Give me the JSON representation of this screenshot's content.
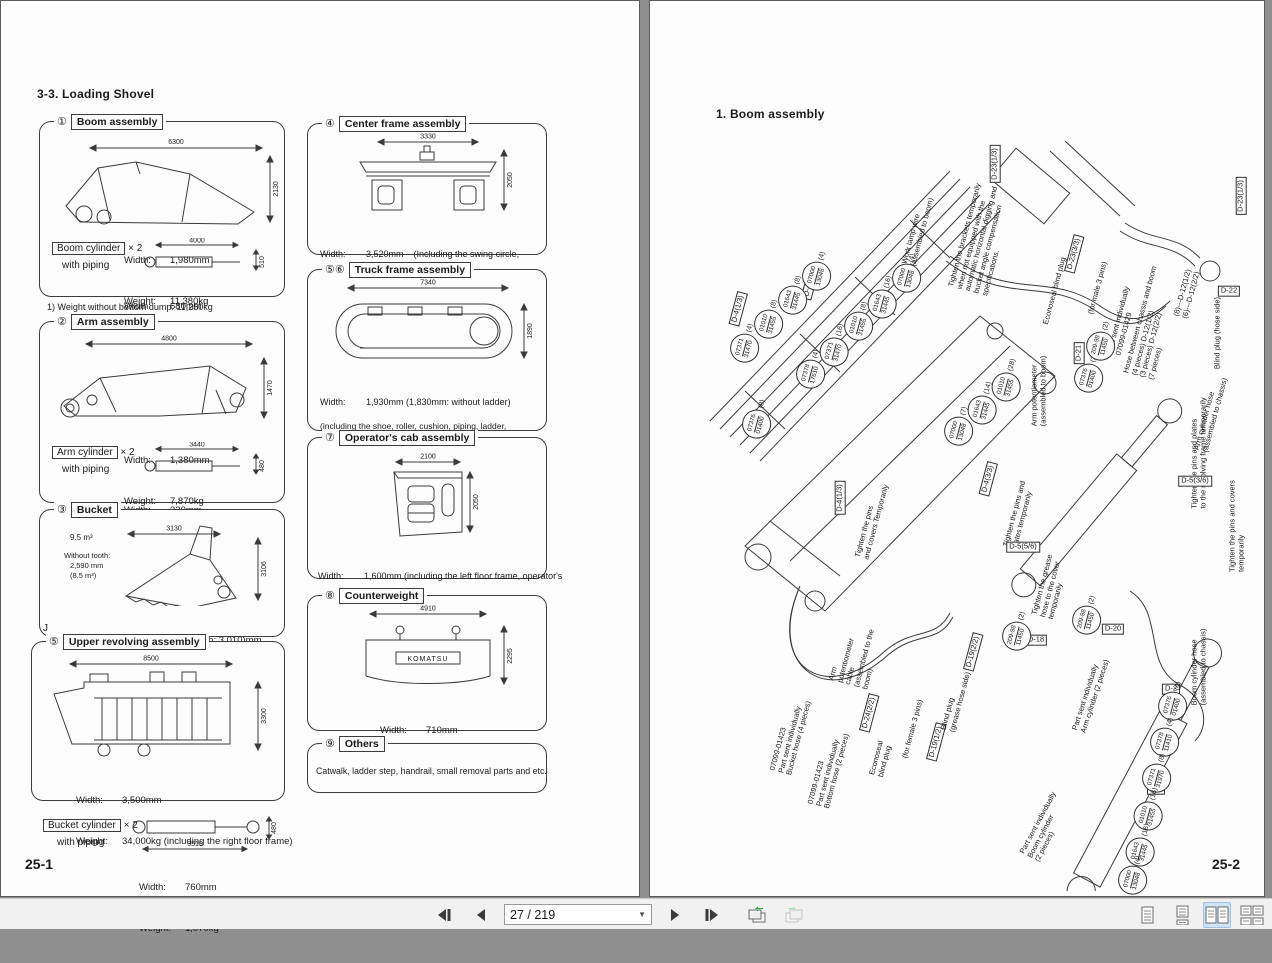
{
  "labels": {
    "width": "Width:",
    "weight": "Weight:"
  },
  "left_page": {
    "heading": "3-3.  Loading Shovel",
    "page_number": "25-1",
    "footnote": "1) Weight without bottom dump:   11,250kg",
    "stray_mark": "J",
    "boxes": {
      "boom": {
        "num": "①",
        "title": "Boom assembly",
        "dim_len": "6300",
        "dim_h": "2130",
        "width": "1,980mm",
        "weight": "11,380kg",
        "cyl_title": "Boom cylinder",
        "cyl_mult": "× 2",
        "cyl_note": "with piping",
        "cyl_dim_len": "4000",
        "cyl_dim_h": "510",
        "cyl_width": "680mm",
        "cyl_weight": "1,880kg"
      },
      "arm": {
        "num": "②",
        "title": "Arm assembly",
        "dim_len": "4800",
        "dim_h": "1470",
        "width": "1,380mm",
        "weight": "7,870kg",
        "cyl_title": "Arm cylinder",
        "cyl_mult": "× 2",
        "cyl_note": "with piping",
        "cyl_dim_len": "3440",
        "cyl_dim_h": "480",
        "cyl_width": "330mm",
        "cyl_weight": "1,075kg"
      },
      "bucket": {
        "num": "③",
        "title": "Bucket",
        "capacity": "9.5 m³",
        "wt1": "Without tooth:",
        "wt2": "2,590 mm",
        "wt3": "(8.5 m³)",
        "dim_len": "3130",
        "dim_h": "3106",
        "width": "3,190 (without tooth: 3,010)mm",
        "weight": "12,730 (without tooth: 12,920)kg"
      },
      "upper": {
        "num": "⑤",
        "title": "Upper revolving assembly",
        "dim_len": "8500",
        "dim_h": "3300",
        "width": "3,500mm",
        "weight": "34,000kg (including the right floor frame)"
      },
      "bucket_cyl": {
        "title": "Bucket cylinder",
        "mult": "× 2",
        "note": "with piping",
        "dim_len": "3510",
        "dim_h": "480",
        "width": "760mm",
        "weight": "1,070kg"
      },
      "center": {
        "num": "④",
        "title": "Center frame assembly",
        "dim_len": "3330",
        "dim_h": "2050",
        "line1": "3,520mm    (Including the swing circle,",
        "line2": "15,300kg     swivel joint and piping)"
      },
      "truck": {
        "num": "⑤⑥",
        "title": "Truck frame assembly",
        "dim_len": "7340",
        "dim_h": "1890",
        "line1": "1,930mm (1,830mm: without ladder)",
        "line2": "24,200kg × 2 (each in symmetry)",
        "note1": "(including the shoe, roller, cushion, piping, ladder,",
        "note2": "final drive, motor, motor guard, and motor cover)"
      },
      "cab": {
        "num": "⑦",
        "title": "Operator's cab assembly",
        "dim_len": "2100",
        "dim_h": "2050",
        "line1": "1,600mm (including the left floor frame, operator's",
        "line2": "850kg         seat and left control stand)"
      },
      "counterweight": {
        "num": "⑧",
        "title": "Counterweight",
        "dim_len": "4910",
        "dim_h": "2295",
        "brand": "KOMATSU",
        "width": "710mm",
        "weight": "21,000kg"
      },
      "others": {
        "num": "⑨",
        "title": "Others",
        "text": "Catwalk, ladder step, handrail, small removal parts and etc."
      }
    }
  },
  "right_page": {
    "heading": "1.  Boom assembly",
    "page_number": "25-2",
    "annotations": [
      {
        "text": "Work lamp wire\n(assembled to boom)",
        "x": 268,
        "y": 230,
        "rot": -75
      },
      {
        "text": "Tighten the brackets temporarily\nwhen not equipped with the\nautomatic horizontal digging and\nbucket angle compensation\nspecifications.",
        "x": 332,
        "y": 238,
        "rot": -75
      },
      {
        "text": "D-23(1/3)",
        "x": 345,
        "y": 163,
        "rot": -90,
        "boxed": true
      },
      {
        "text": "Econoseal blind plug",
        "x": 405,
        "y": 290,
        "rot": -75
      },
      {
        "text": "D-23(3/3)",
        "x": 424,
        "y": 253,
        "rot": -75,
        "boxed": true
      },
      {
        "text": "(for male 3 pins)",
        "x": 448,
        "y": 287,
        "rot": -75
      },
      {
        "text": "Part sent individually\n07099-01429",
        "x": 473,
        "y": 320,
        "rot": -75
      },
      {
        "text": "Hose between chassis and boom\n(4 pieces) D-12(1/2)\n(3 pieces) D-12(2/2)\n(7 pieces)",
        "x": 503,
        "y": 322,
        "rot": -75
      },
      {
        "text": "(8)---D-12(1/2)\n(6)---D-12(2/2)",
        "x": 537,
        "y": 293,
        "rot": -75
      },
      {
        "text": "D-23(1/3)",
        "x": 591,
        "y": 195,
        "rot": -90,
        "boxed": true
      },
      {
        "text": "Blind plug (hose side)",
        "x": 568,
        "y": 332,
        "rot": -90
      },
      {
        "text": "D-22",
        "x": 579,
        "y": 290,
        "rot": 0,
        "boxed": true
      },
      {
        "text": "Tighten the pins and plates\nto the revolving frame temporarily",
        "x": 549,
        "y": 452,
        "rot": -90
      },
      {
        "text": "D-5(3/6)",
        "x": 545,
        "y": 480,
        "rot": 0,
        "boxed": true
      },
      {
        "text": "Tighten the pins and covers\ntemporarily",
        "x": 587,
        "y": 525,
        "rot": -90
      },
      {
        "text": "Arm cylinder hose\n(assembled to chassis)",
        "x": 561,
        "y": 413,
        "rot": -75
      },
      {
        "text": "D-4(1/3)",
        "x": 88,
        "y": 308,
        "rot": -75,
        "boxed": true
      },
      {
        "text": "D-4(1/3)",
        "x": 160,
        "y": 282,
        "rot": -75,
        "boxed": true
      },
      {
        "text": "D-4(1/3)",
        "x": 190,
        "y": 497,
        "rot": -90,
        "boxed": true
      },
      {
        "text": "Arm potentiometer\n(assembled to boom)",
        "x": 389,
        "y": 390,
        "rot": -90
      },
      {
        "text": "Tighten the pins\nand covers Temporarily",
        "x": 222,
        "y": 520,
        "rot": -75
      },
      {
        "text": "D-4(3/3)",
        "x": 338,
        "y": 478,
        "rot": -75,
        "boxed": true
      },
      {
        "text": "Tighten the pins and\nplates temporarily",
        "x": 369,
        "y": 514,
        "rot": -75
      },
      {
        "text": "D-5(5/6)",
        "x": 373,
        "y": 546,
        "rot": 0,
        "boxed": true
      },
      {
        "text": "Tighten the grease\nhose to the cover\ntemporarily",
        "x": 401,
        "y": 586,
        "rot": -75
      },
      {
        "text": "D-21",
        "x": 429,
        "y": 352,
        "rot": -90,
        "boxed": true
      },
      {
        "text": "D-20",
        "x": 463,
        "y": 628,
        "rot": 0,
        "boxed": true
      },
      {
        "text": "D-18",
        "x": 386,
        "y": 639,
        "rot": 0,
        "boxed": true
      },
      {
        "text": "Arm\npotentiometer\ncable\n(assembled to the\nboom)",
        "x": 206,
        "y": 655,
        "rot": -75
      },
      {
        "text": "Part sent individually\nArm cylinder (2 pieces)",
        "x": 441,
        "y": 694,
        "rot": -72
      },
      {
        "text": "07099-01423\nPart sent individually\nBucket hose (4 pieces)",
        "x": 141,
        "y": 735,
        "rot": -75
      },
      {
        "text": "07099-01423\nPart sent individually\nBottom hose (2 pieces)",
        "x": 179,
        "y": 768,
        "rot": -75
      },
      {
        "text": "D-24(2/2)",
        "x": 219,
        "y": 712,
        "rot": -75,
        "boxed": true
      },
      {
        "text": "Econoseal\nblind plug",
        "x": 231,
        "y": 758,
        "rot": -75
      },
      {
        "text": "(for female 3 pins)",
        "x": 263,
        "y": 728,
        "rot": -75
      },
      {
        "text": "D-19(1/2)",
        "x": 286,
        "y": 741,
        "rot": -75,
        "boxed": true
      },
      {
        "text": "Blind plug\n(grease hose side)",
        "x": 306,
        "y": 700,
        "rot": -75
      },
      {
        "text": "D-19(2/2)",
        "x": 323,
        "y": 651,
        "rot": -75,
        "boxed": true
      },
      {
        "text": "Part sent individually\nBoom cylinder\n(2 pieces)",
        "x": 396,
        "y": 826,
        "rot": -62
      },
      {
        "text": "Boom cylinder hose\n(assembled to chassis)",
        "x": 549,
        "y": 666,
        "rot": -90
      },
      {
        "text": "D-2",
        "x": 521,
        "y": 688,
        "rot": 0,
        "boxed": true
      },
      {
        "text": "D-2",
        "x": 506,
        "y": 788,
        "rot": 0,
        "boxed": true
      }
    ],
    "part_circles": [
      {
        "top": "07371",
        "bottom": "31470",
        "count": "(4)",
        "x": 96,
        "y": 342
      },
      {
        "top": "01010",
        "bottom": "31455",
        "count": "(8)",
        "x": 120,
        "y": 318
      },
      {
        "top": "01643",
        "bottom": "31445",
        "count": "(8)",
        "x": 144,
        "y": 294
      },
      {
        "top": "07000",
        "bottom": "13048",
        "count": "(4)",
        "x": 168,
        "y": 270
      },
      {
        "top": "07378",
        "bottom": "17610",
        "count": "(4)",
        "x": 162,
        "y": 368
      },
      {
        "top": "07371",
        "bottom": "31470",
        "count": "(16)",
        "x": 186,
        "y": 344
      },
      {
        "top": "01010",
        "bottom": "31455",
        "count": "(8)",
        "x": 210,
        "y": 320
      },
      {
        "top": "01643",
        "bottom": "31445",
        "count": "(16)",
        "x": 234,
        "y": 296
      },
      {
        "top": "07000",
        "bottom": "13048",
        "count": "(4)",
        "x": 258,
        "y": 272
      },
      {
        "top": "07376",
        "bottom": "01400",
        "count": "(8)",
        "x": 108,
        "y": 418
      },
      {
        "top": "07000",
        "bottom": "13048",
        "count": "(7)",
        "x": 310,
        "y": 425
      },
      {
        "top": "01643",
        "bottom": "31445",
        "count": "(14)",
        "x": 334,
        "y": 402
      },
      {
        "top": "01010",
        "bottom": "31455",
        "count": "(28)",
        "x": 358,
        "y": 379
      },
      {
        "top": "07376",
        "bottom": "01400",
        "count": "(2)",
        "x": 440,
        "y": 372
      },
      {
        "top": "209-98",
        "bottom": "11450",
        "count": "(2)",
        "x": 452,
        "y": 340
      },
      {
        "top": "209-98",
        "bottom": "11450",
        "count": "(2)",
        "x": 368,
        "y": 630
      },
      {
        "top": "209-98",
        "bottom": "11450",
        "count": "(2)",
        "x": 438,
        "y": 614
      },
      {
        "top": "07376",
        "bottom": "01400",
        "count": "(4)",
        "x": 524,
        "y": 700
      },
      {
        "top": "07378",
        "bottom": "11410",
        "count": "(4)",
        "x": 516,
        "y": 736
      },
      {
        "top": "07371",
        "bottom": "31970",
        "count": "(8)",
        "x": 508,
        "y": 772
      },
      {
        "top": "01010",
        "bottom": "31455",
        "count": "(16)",
        "x": 500,
        "y": 808
      },
      {
        "top": "01643",
        "bottom": "31445",
        "count": "(16)",
        "x": 492,
        "y": 844
      },
      {
        "top": "07000",
        "bottom": "13048",
        "count": "(4)",
        "x": 484,
        "y": 874
      }
    ]
  },
  "toolbar": {
    "page_indicator": "27 / 219",
    "icons": [
      "first-page",
      "previous-page",
      "next-page",
      "last-page",
      "previous-view",
      "next-view",
      "single-page-view",
      "continuous-view",
      "facing-view",
      "continuous-facing-view"
    ],
    "active_view": "facing-view"
  },
  "colors": {
    "toolbar_bg": "#f1f1f1",
    "canvas_bg": "#8f8f8f",
    "active_icon_bg": "#cfe3f6",
    "icon_color": "#3a3a3a",
    "history_arrow_green": "#2f9e44"
  }
}
